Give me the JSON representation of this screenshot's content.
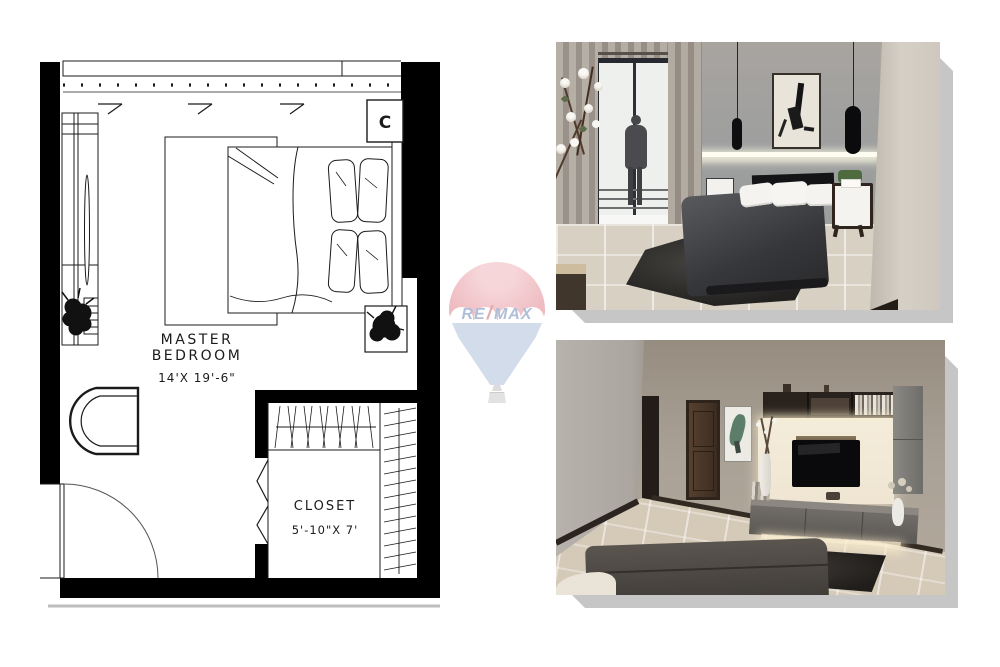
{
  "floor_plan": {
    "room_name_line1": "MASTER",
    "room_name_line2": "BEDROOM",
    "room_size": "14'X 19'-6\"",
    "closet_name": "CLOSET",
    "closet_size": "5'-10\"X 7'",
    "ac_marker": "C"
  },
  "watermark": {
    "brand_left": "RE",
    "brand_slash": "/",
    "brand_right": "MAX"
  },
  "colors": {
    "plan_line": "#1b1b1b",
    "card_shadow": "#c6c6c6",
    "balloon_red": "#eebbc0",
    "balloon_blue": "#d2dcea",
    "brand_text_blue": "#afbfd9",
    "brand_text_red": "#e2a9af",
    "render_wall_gray": "#a49f99",
    "render_floor_beige": "#d8d1c3",
    "render_dark_furniture": "#3a3a3e"
  }
}
